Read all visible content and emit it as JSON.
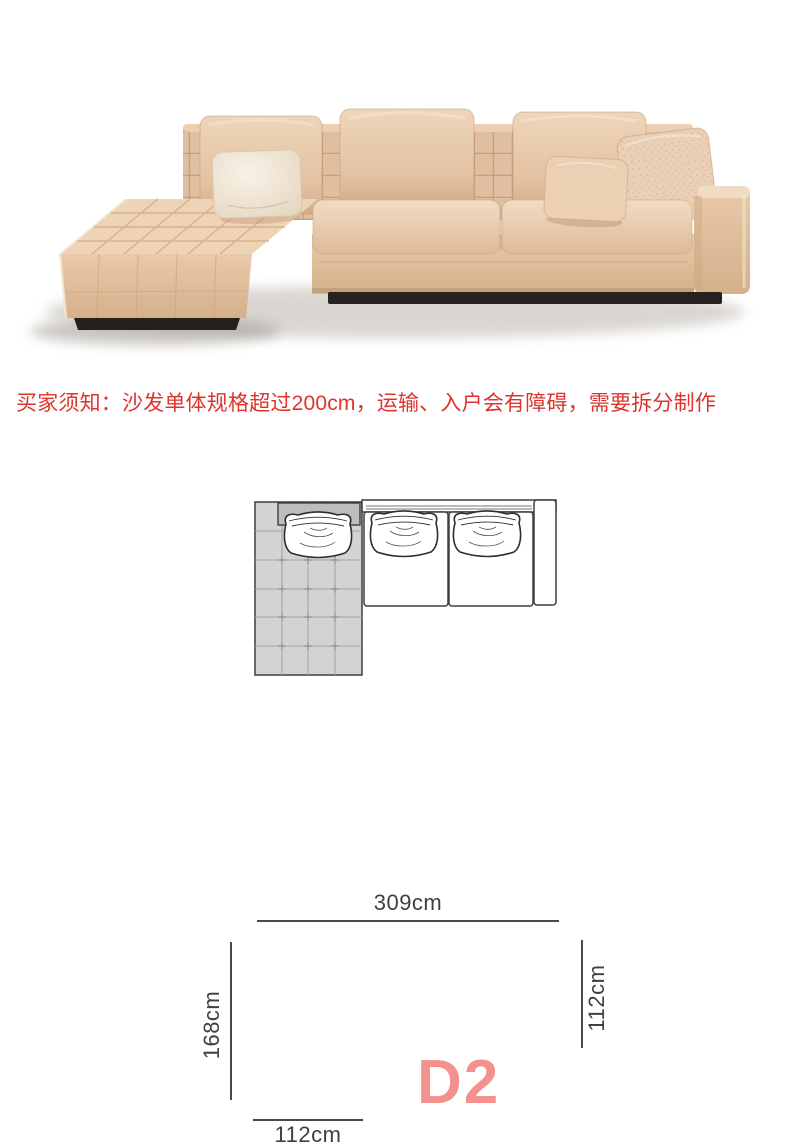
{
  "notice": {
    "text": "买家须知：沙发单体规格超过200cm，运输、入户会有障碍，需要拆分制作",
    "color": "#dd342e"
  },
  "photo": {
    "subject": "beige-l-shaped-sectional-sofa-with-left-chaise",
    "fabric_color": "#e8cbad",
    "fabric_highlight_color": "#f1dcc4",
    "fabric_shadow_color": "#d3ac87",
    "cream_pillow_color": "#f3ebdc",
    "plinth_color": "#262220"
  },
  "diagram": {
    "total_width_label": "309cm",
    "chaise_depth_label": "168cm",
    "seat_depth_label": "112cm",
    "chaise_width_label": "112cm",
    "model_code": "D2",
    "model_color": "#f2918d",
    "line_color": "#4a4a4a",
    "label_color": "#404040",
    "chaise_fill": "#d3d3d3",
    "headrest_fill": "#bdbdbd"
  }
}
